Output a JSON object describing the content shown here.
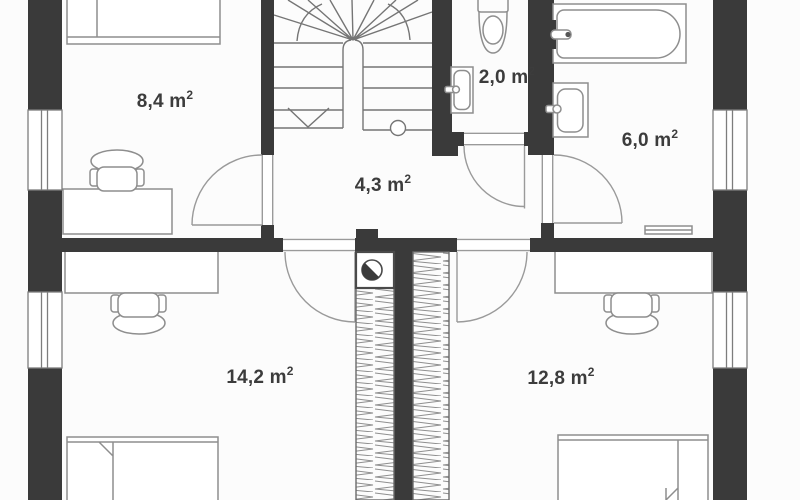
{
  "plan": {
    "type": "floor-plan",
    "floor_rooms_count": 6
  },
  "colors": {
    "wall": "#3a3a3a",
    "furniture_line": "#8e8e8e",
    "door_line": "#9a9a9a",
    "stair_line": "#757575",
    "window_line": "#7d7d7d",
    "label_text": "#3c3c3c",
    "background": "#fcfcfc"
  },
  "rooms": [
    {
      "id": "bedroom-top-left",
      "area": "8,4 m",
      "sup": "2"
    },
    {
      "id": "hallway",
      "area": "4,3 m",
      "sup": "2"
    },
    {
      "id": "wc",
      "area": "2,0 m",
      "sup": "2"
    },
    {
      "id": "bathroom",
      "area": "6,0 m",
      "sup": "2"
    },
    {
      "id": "bedroom-bottom-left",
      "area": "14,2 m",
      "sup": "2"
    },
    {
      "id": "bedroom-bottom-right",
      "area": "12,8 m",
      "sup": "2"
    }
  ]
}
